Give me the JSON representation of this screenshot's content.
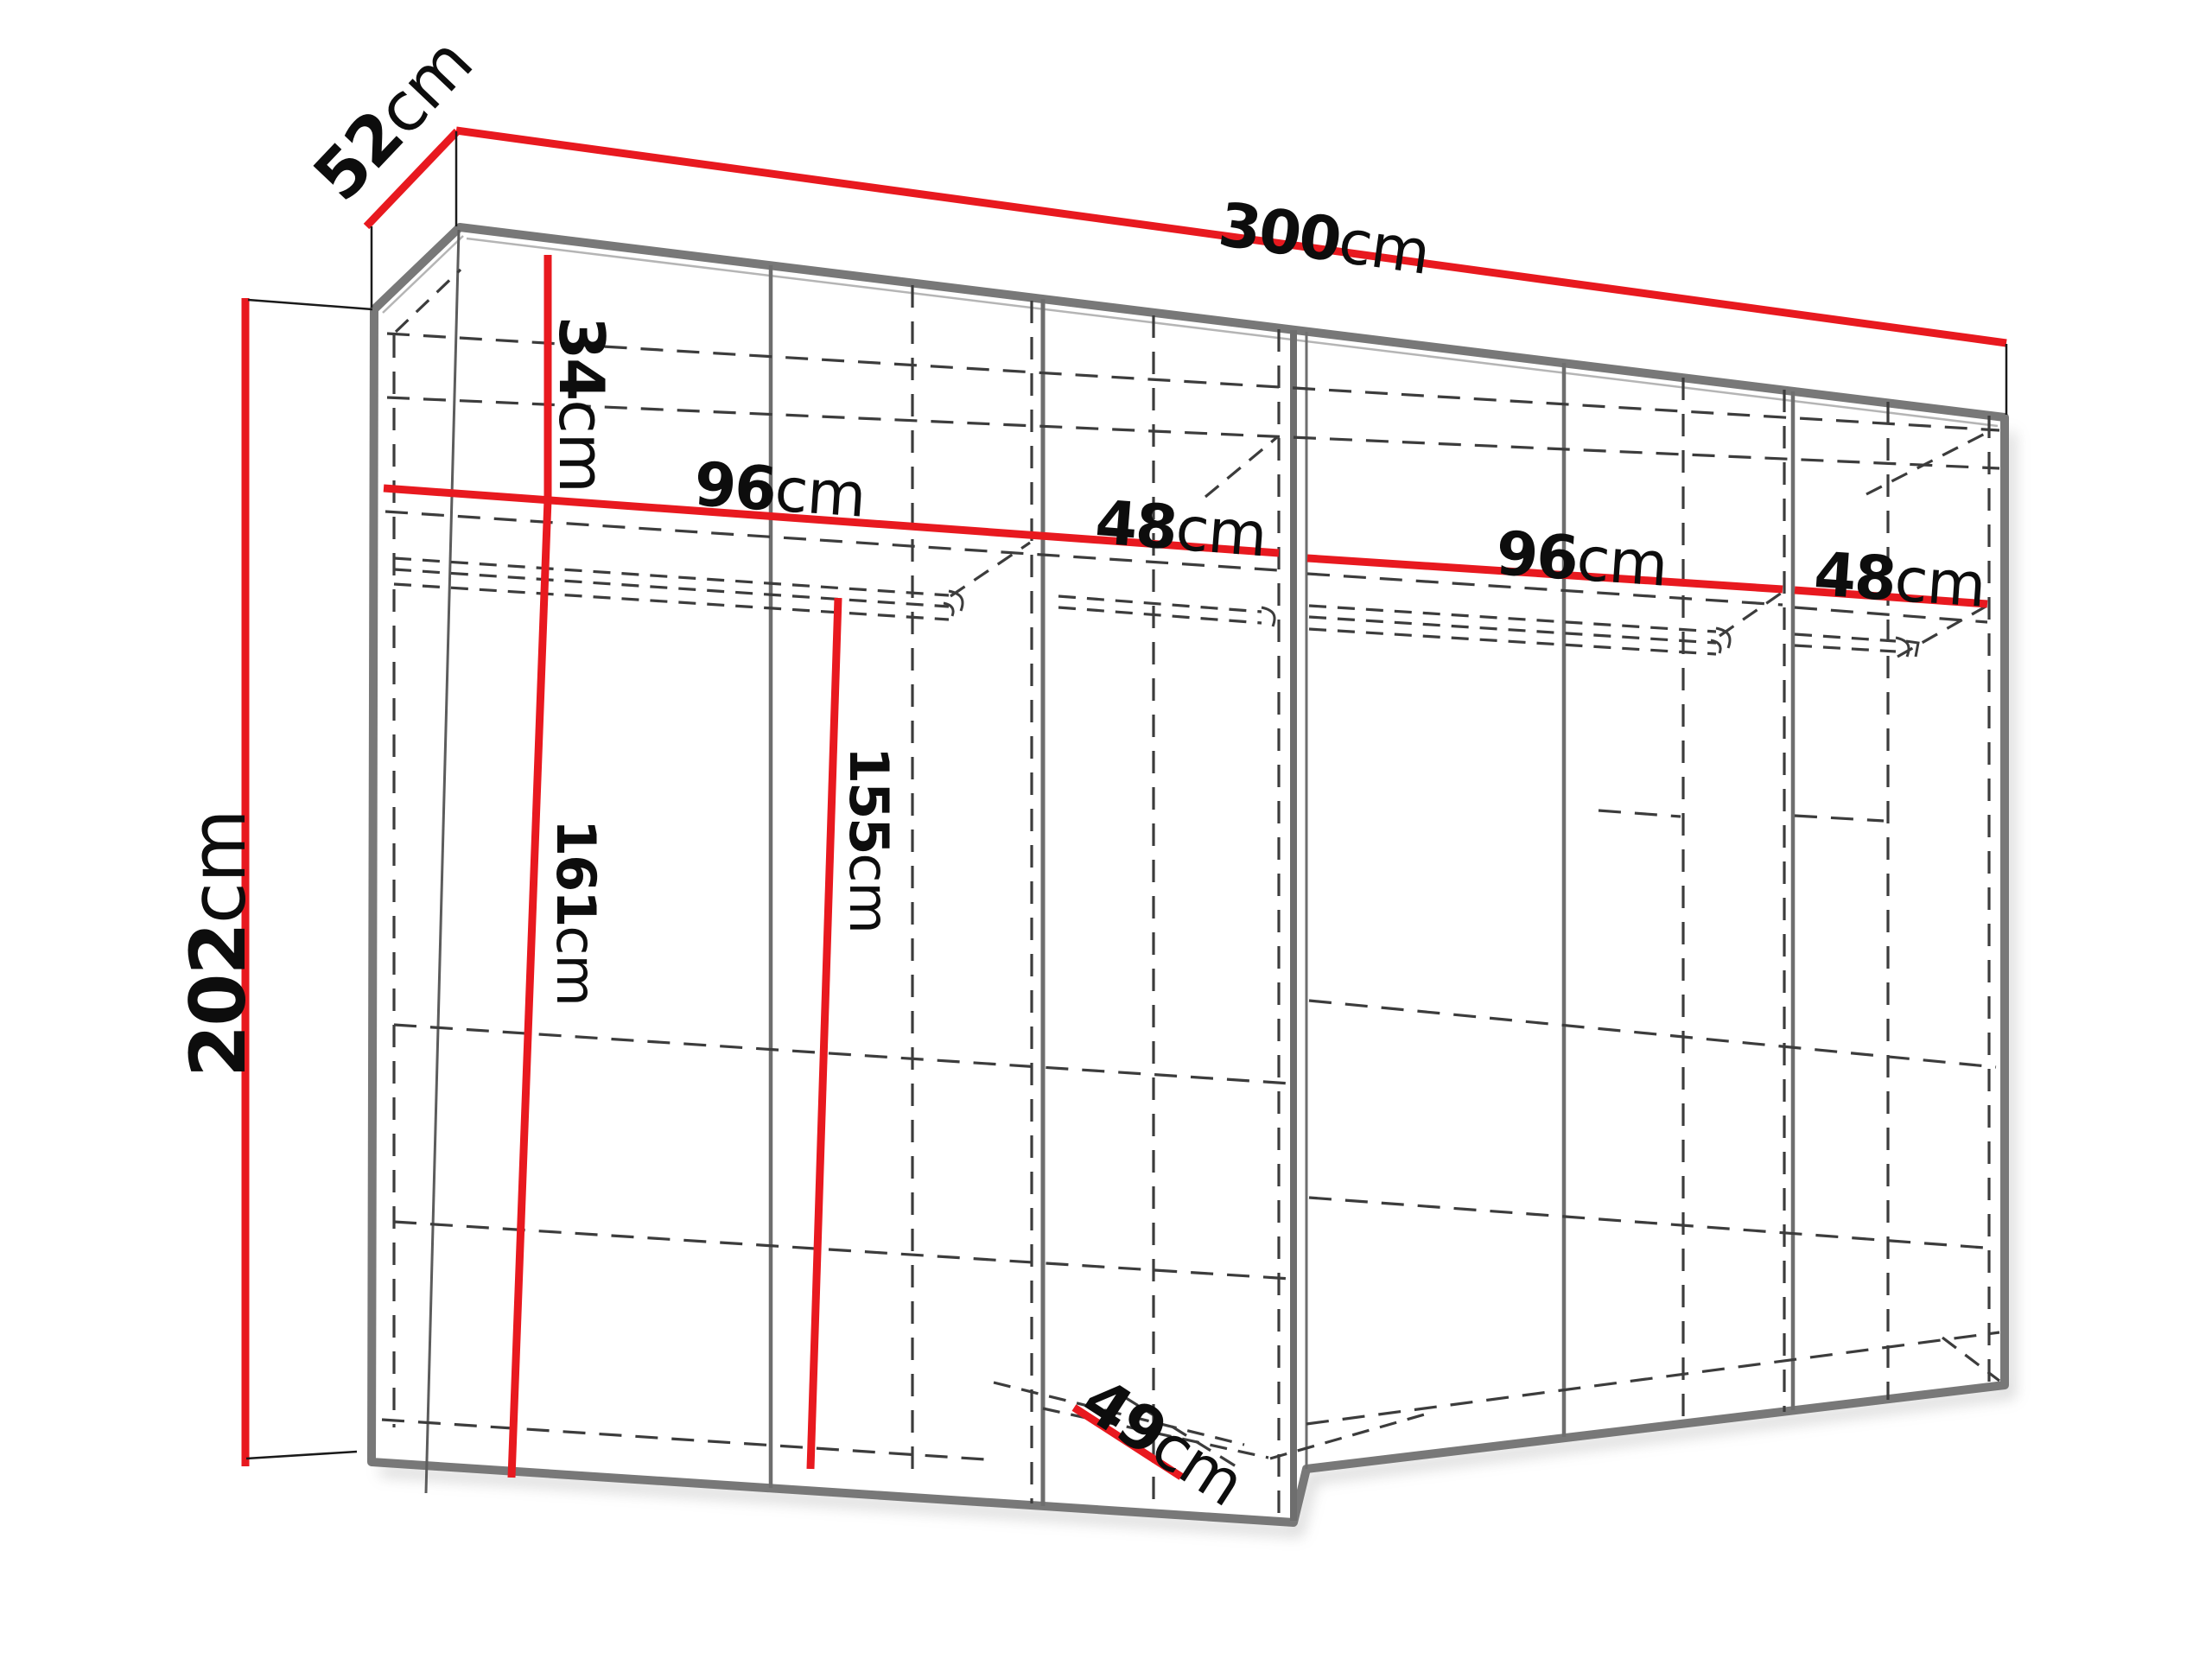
{
  "title": "Wardrobe dimension diagram",
  "colors": {
    "dimension_red": "#e8191f",
    "edge_gray": "#787878",
    "partition_gray": "#6e6e6e",
    "dash_dark": "#3c3c3c",
    "text_black": "#0d0d0d",
    "background": "#ffffff"
  },
  "labels": {
    "width": {
      "num": "300",
      "unit": "cm"
    },
    "depth": {
      "num": "52",
      "unit": "cm"
    },
    "height": {
      "num": "202",
      "unit": "cm"
    },
    "top_section": {
      "num": "34",
      "unit": "cm"
    },
    "left_hang": {
      "num": "161",
      "unit": "cm"
    },
    "mid_hang": {
      "num": "155",
      "unit": "cm"
    },
    "bottom_depth": {
      "num": "49",
      "unit": "cm"
    },
    "sec1": {
      "num": "96",
      "unit": "cm"
    },
    "sec2": {
      "num": "48",
      "unit": "cm"
    },
    "sec3": {
      "num": "96",
      "unit": "cm"
    },
    "sec4": {
      "num": "48",
      "unit": "cm"
    }
  }
}
